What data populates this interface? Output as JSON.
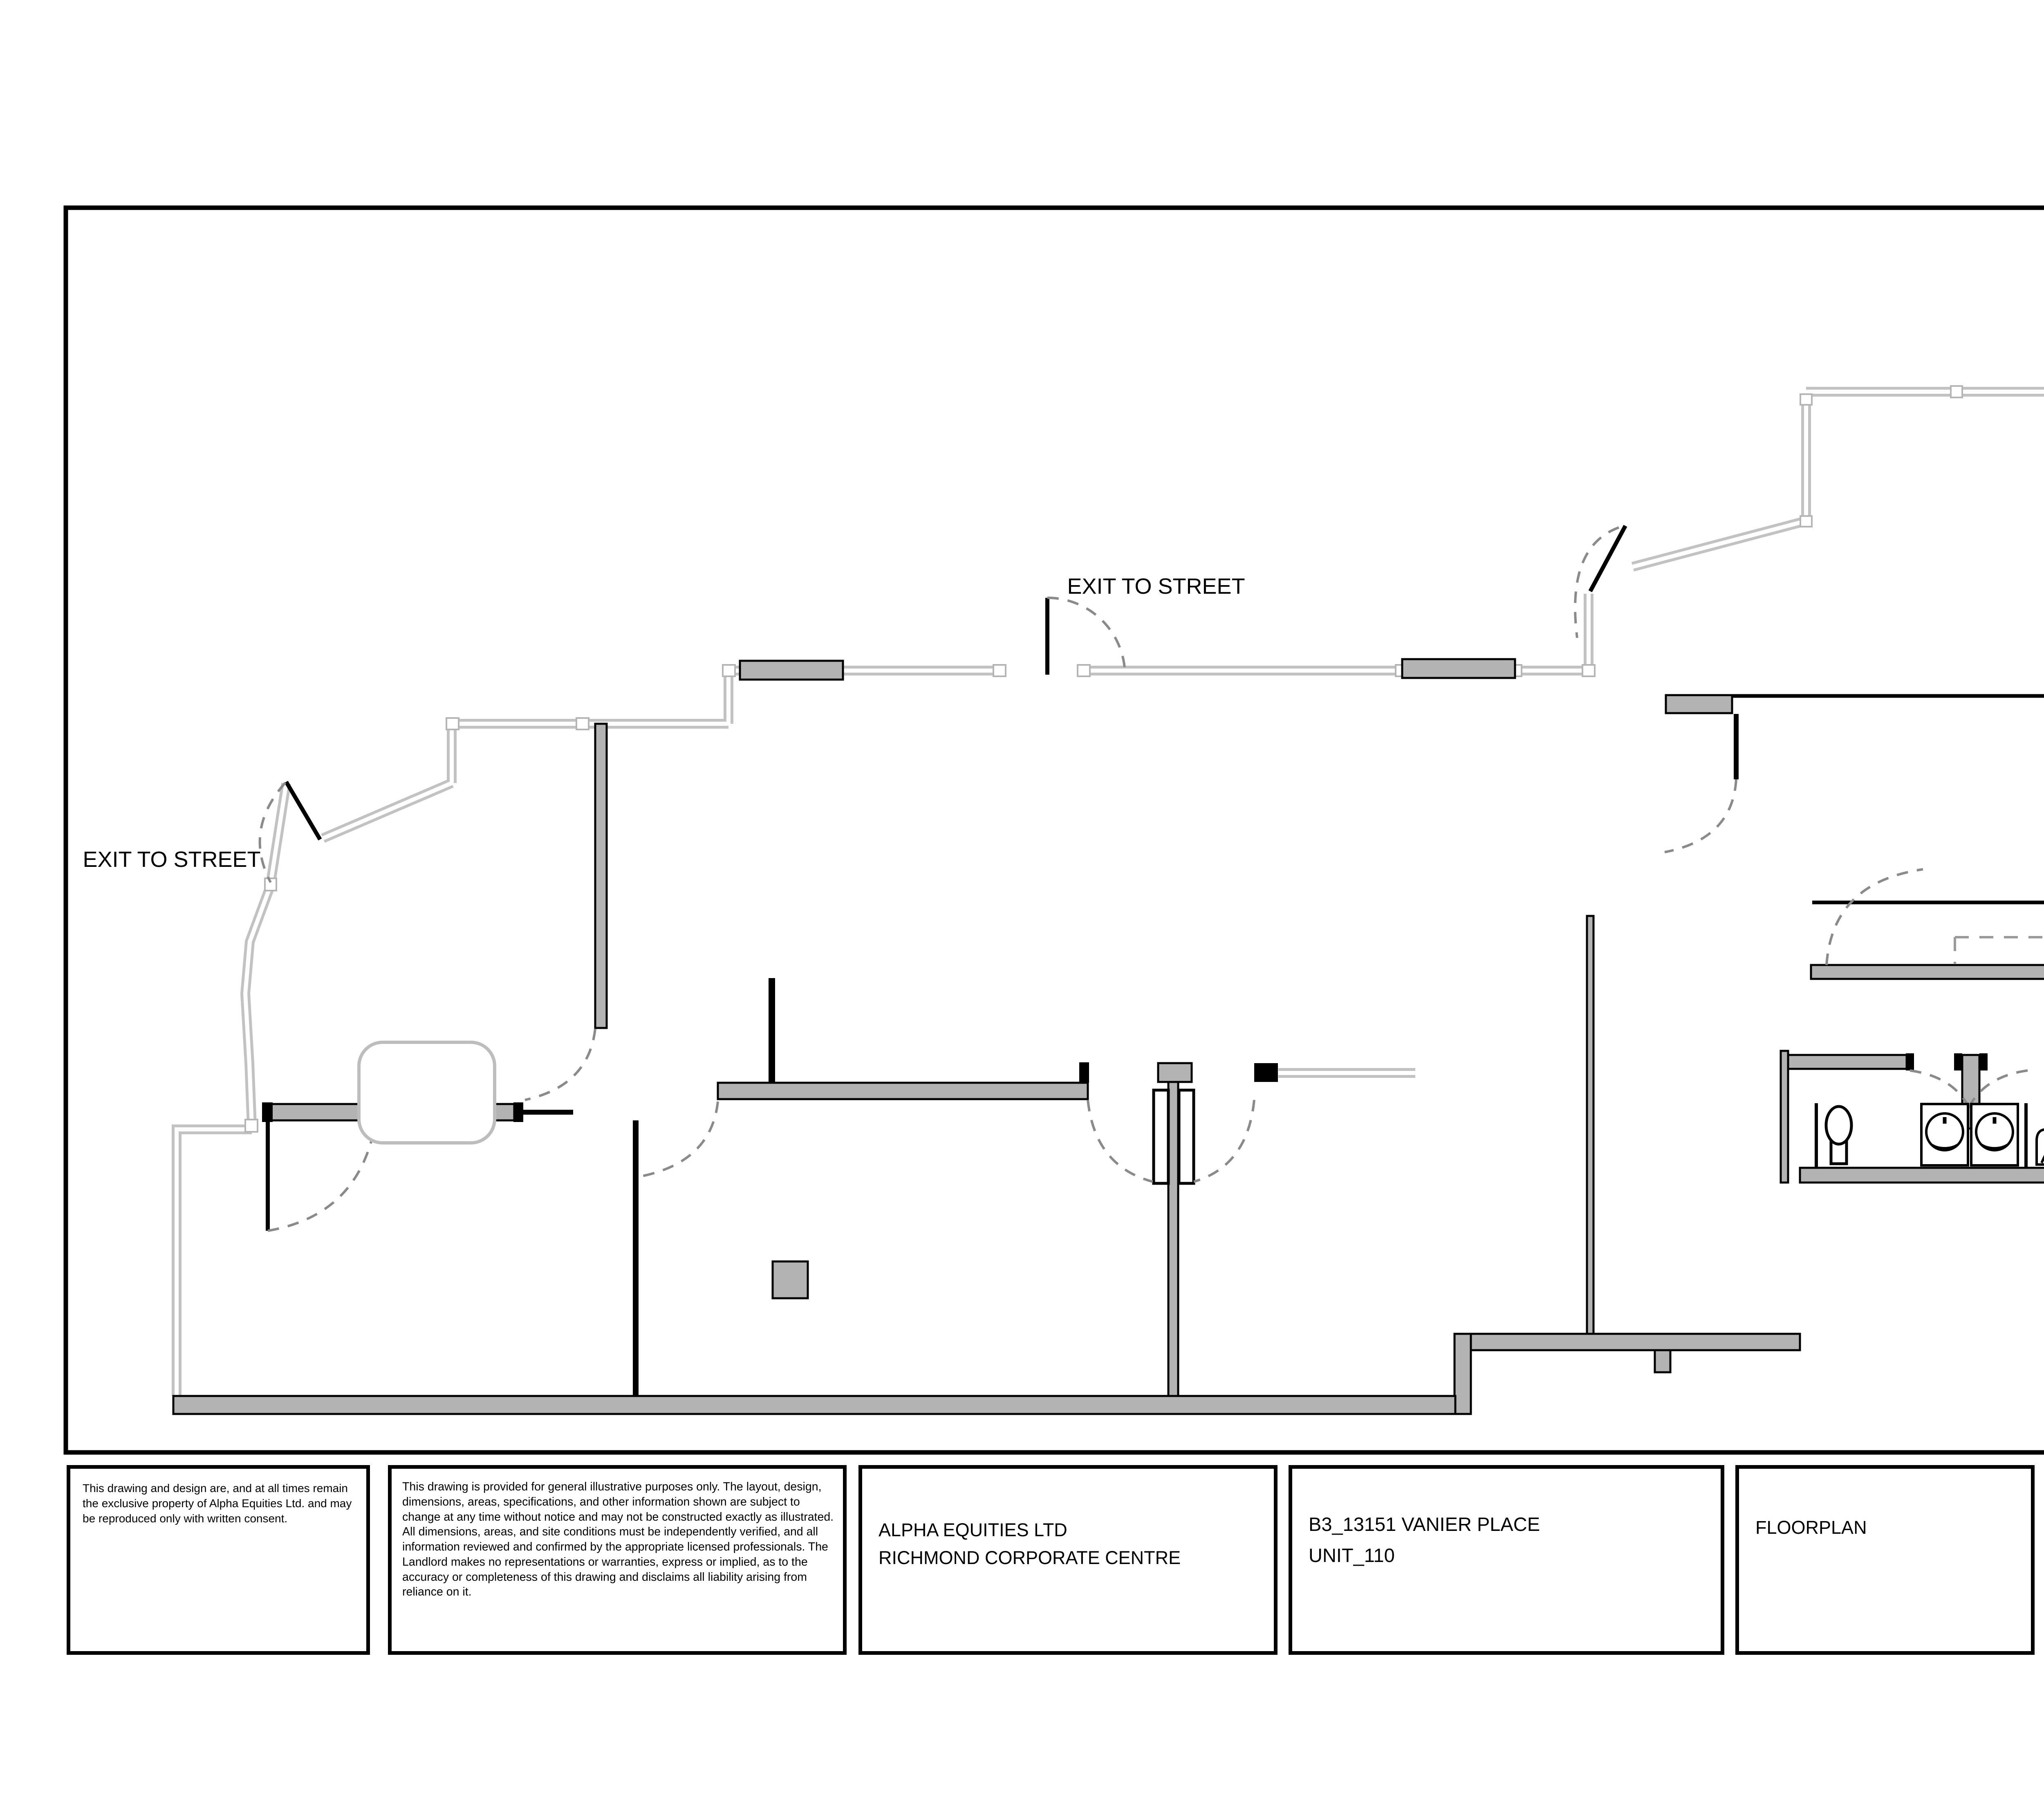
{
  "drawing": {
    "exit_label_top": "EXIT TO STREET",
    "exit_label_left": "EXIT TO STREET"
  },
  "title_block": {
    "copyright": "This drawing and design are, and at all times remain the exclusive property of Alpha Equities Ltd. and may be reproduced only with written consent.",
    "disclaimer": "This drawing is provided for general illustrative purposes only. The layout, design, dimensions, areas, specifications, and other information shown are subject to change at any time without notice and may not be constructed exactly as illustrated. All dimensions, areas, and site conditions must be independently verified, and all information reviewed and confirmed by the appropriate licensed professionals. The Landlord makes no representations or warranties, express or implied, as to the accuracy or completeness of this drawing and disclaims all liability arising from reliance on it.",
    "company_lines": "ALPHA EQUITIES LTD\nRICHMOND CORPORATE CENTRE",
    "project_lines": "B3_13151 VANIER PLACE\nUNIT_110",
    "sheet_title": "FLOORPLAN"
  },
  "logo": {
    "name": "ALPHA",
    "subtitle": "EQUITIES LTD",
    "color_primary": "#155548",
    "color_secondary": "#2f6a5c"
  },
  "colors": {
    "wall_fill": "#b3b3b3",
    "window_line": "#c2c2c2",
    "door_arc": "#8a8a8a"
  }
}
